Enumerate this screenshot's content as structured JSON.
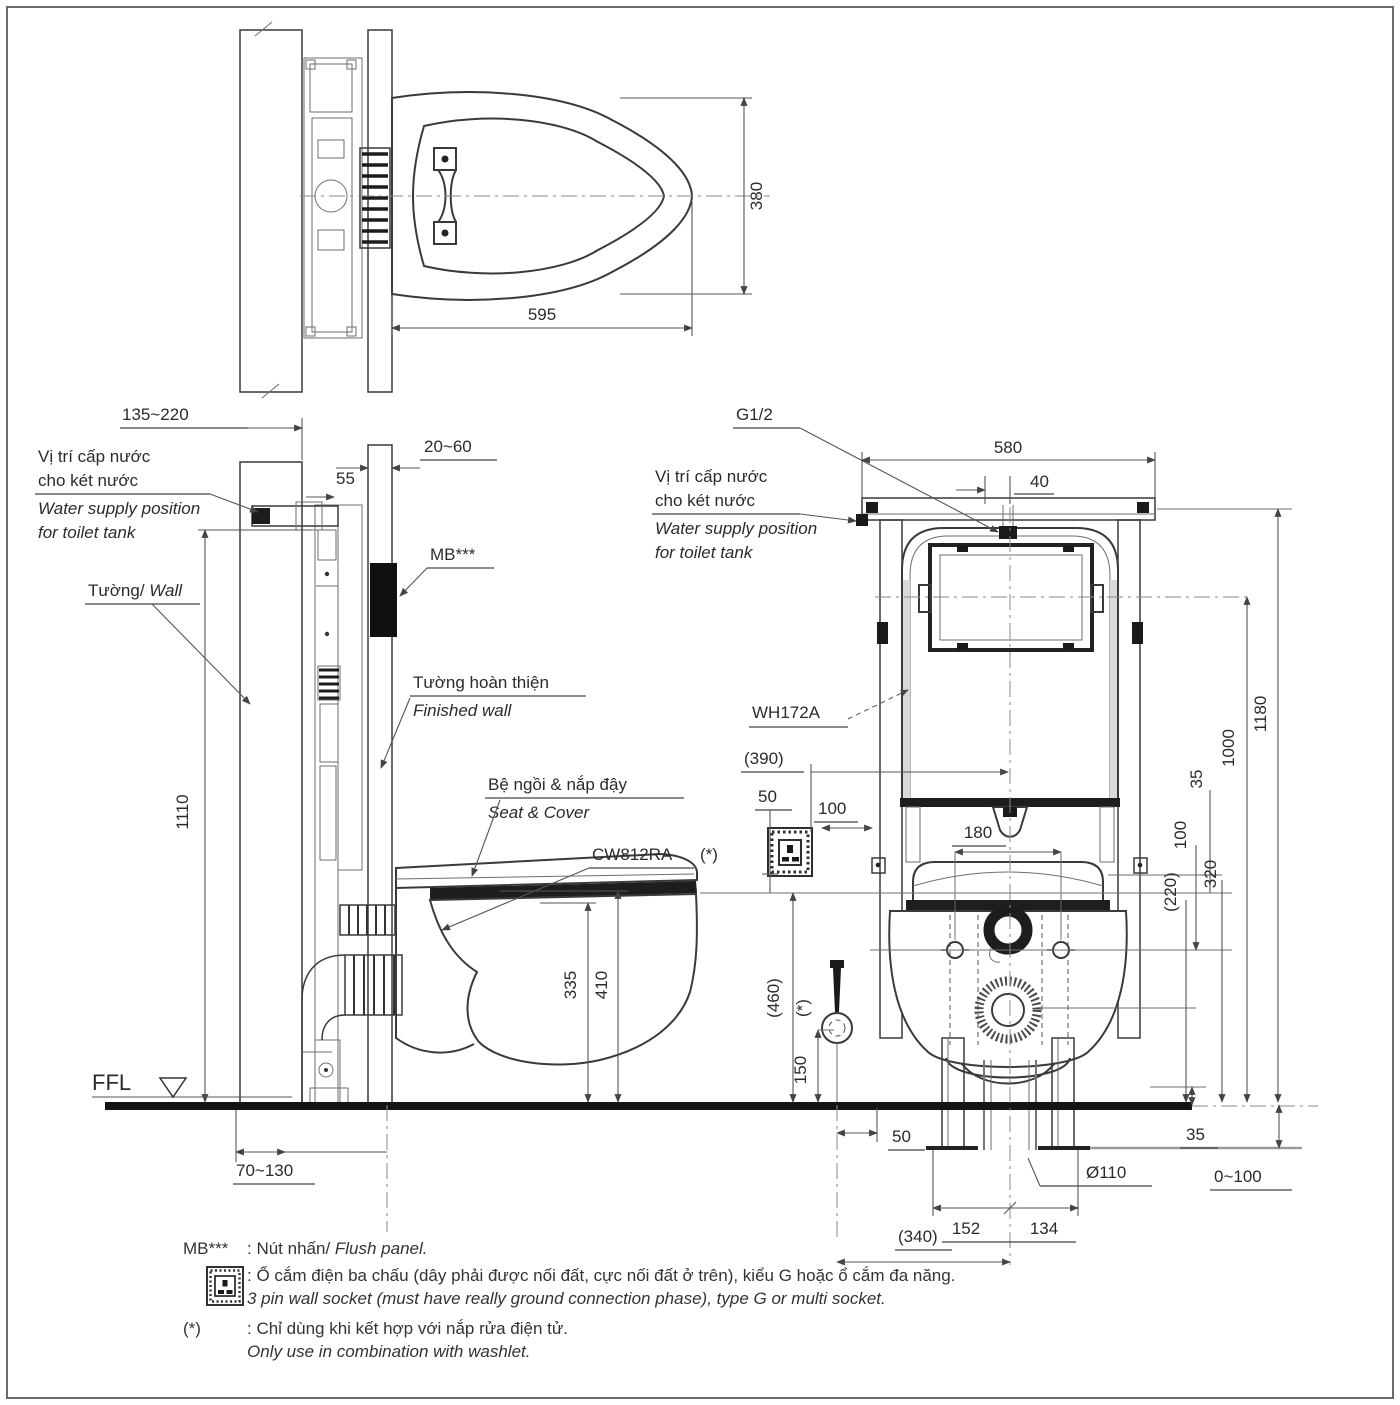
{
  "top_view": {
    "dim_width": "595",
    "dim_depth": "380"
  },
  "side_view": {
    "dim_wall_range": "135~220",
    "dim_finish_range": "20~60",
    "dim_55": "55",
    "water_supply_vi_1": "Vị trí cấp nước",
    "water_supply_vi_2": "cho két nước",
    "water_supply_en_1": "Water supply position",
    "water_supply_en_2": "for toilet tank",
    "wall_vi": "Tường/",
    "wall_en": " Wall",
    "mb_label": "MB***",
    "finished_wall_vi": "Tường hoàn thiện",
    "finished_wall_en": "Finished wall",
    "seat_cover_vi": "Bệ ngồi & nắp đậy",
    "seat_cover_en": "Seat & Cover",
    "model": "CW812RA",
    "dim_1110": "1110",
    "dim_335": "335",
    "dim_410": "410",
    "ffl": "FFL",
    "dim_70_130": "70~130"
  },
  "front_view": {
    "g_half": "G1/2",
    "water_supply_vi_1": "Vị trí cấp nước",
    "water_supply_vi_2": "cho két nước",
    "water_supply_en_1": "Water supply position",
    "water_supply_en_2": "for toilet tank",
    "model": "WH172A",
    "dim_580": "580",
    "dim_40": "40",
    "dim_390": "(390)",
    "dim_50_socket": "50",
    "dim_100_socket": "100",
    "dim_180": "180",
    "star": "(*)",
    "star_valve": "(*)",
    "dim_460": "(460)",
    "dim_150": "150",
    "dim_1180": "1180",
    "dim_1000": "1000",
    "dim_35_seat": "35",
    "dim_100_right": "100",
    "dim_320": "320",
    "dim_220": "(220)",
    "dim_50_floor": "50",
    "dim_35_floor": "35",
    "dim_dia110": "Ø110",
    "dim_0_100": "0~100",
    "dim_152": "152",
    "dim_134": "134",
    "dim_340": "(340)"
  },
  "legend": {
    "mb_term": "MB***",
    "mb_def_vi": ": Nút nhấn/ ",
    "mb_def_en": "Flush panel.",
    "socket_def_vi": ": Ổ cắm điện ba chấu (dây phải được nối đất, cực nối đất ở trên), kiểu G hoặc ổ cắm đa năng.",
    "socket_def_en": "3 pin wall socket (must have really ground connection phase), type G or multi socket.",
    "star_term": "(*)",
    "star_def_vi": ": Chỉ dùng khi kết hợp với nắp rửa điện tử.",
    "star_def_en": "Only use in combination with washlet."
  }
}
